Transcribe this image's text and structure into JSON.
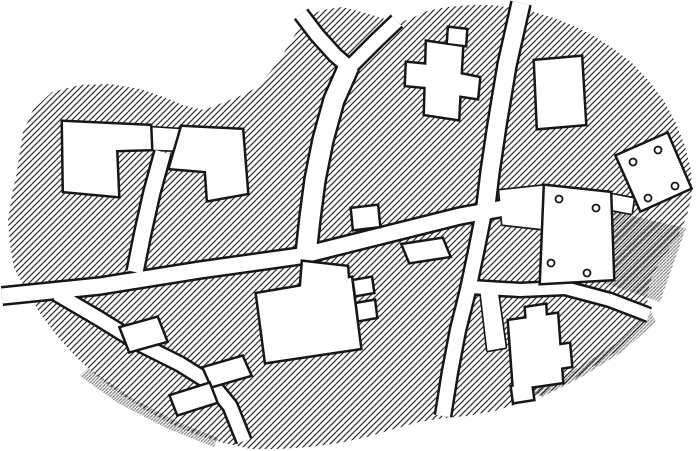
{
  "map": {
    "canvas": {
      "width": 700,
      "height": 451
    },
    "colors": {
      "paper": "#ffffff",
      "ink": "#161616",
      "hatch_line": "#2b2b2b",
      "hatch_dense": "#101010",
      "building_fill": "#ffffff",
      "road_fill": "#ffffff"
    },
    "hatch": {
      "spacing": 6,
      "line_width": 1.15,
      "dense_spacing": 3.4,
      "dense_line_width": 1.3,
      "shadow_opacity": 0.5
    },
    "boundary": [
      [
        14,
        268
      ],
      [
        10,
        245
      ],
      [
        8,
        220
      ],
      [
        12,
        195
      ],
      [
        17,
        172
      ],
      [
        20,
        150
      ],
      [
        23,
        132
      ],
      [
        33,
        110
      ],
      [
        52,
        92
      ],
      [
        80,
        85
      ],
      [
        110,
        84
      ],
      [
        140,
        89
      ],
      [
        164,
        97
      ],
      [
        185,
        106
      ],
      [
        204,
        110
      ],
      [
        222,
        103
      ],
      [
        240,
        96
      ],
      [
        256,
        88
      ],
      [
        271,
        71
      ],
      [
        285,
        51
      ],
      [
        296,
        33
      ],
      [
        304,
        18
      ],
      [
        322,
        10
      ],
      [
        342,
        7
      ],
      [
        362,
        12
      ],
      [
        382,
        18
      ],
      [
        396,
        23
      ],
      [
        410,
        19
      ],
      [
        427,
        11
      ],
      [
        447,
        7
      ],
      [
        470,
        5
      ],
      [
        492,
        5
      ],
      [
        514,
        8
      ],
      [
        534,
        12
      ],
      [
        554,
        18
      ],
      [
        574,
        26
      ],
      [
        594,
        36
      ],
      [
        614,
        49
      ],
      [
        632,
        63
      ],
      [
        649,
        81
      ],
      [
        664,
        101
      ],
      [
        676,
        123
      ],
      [
        685,
        146
      ],
      [
        691,
        170
      ],
      [
        692,
        194
      ],
      [
        687,
        216
      ],
      [
        679,
        234
      ],
      [
        669,
        249
      ],
      [
        659,
        263
      ],
      [
        651,
        279
      ],
      [
        647,
        296
      ],
      [
        649,
        313
      ],
      [
        644,
        326
      ],
      [
        631,
        339
      ],
      [
        614,
        353
      ],
      [
        594,
        366
      ],
      [
        571,
        381
      ],
      [
        547,
        393
      ],
      [
        521,
        403
      ],
      [
        494,
        411
      ],
      [
        467,
        416
      ],
      [
        444,
        418
      ],
      [
        419,
        422
      ],
      [
        394,
        429
      ],
      [
        367,
        437
      ],
      [
        339,
        443
      ],
      [
        309,
        447
      ],
      [
        279,
        449
      ],
      [
        251,
        449
      ],
      [
        224,
        443
      ],
      [
        197,
        435
      ],
      [
        171,
        424
      ],
      [
        147,
        411
      ],
      [
        123,
        396
      ],
      [
        99,
        378
      ],
      [
        77,
        358
      ],
      [
        57,
        336
      ],
      [
        39,
        312
      ],
      [
        25,
        288
      ]
    ],
    "shadows": [
      {
        "name": "shadow-east-slope",
        "points": [
          [
            615,
            212
          ],
          [
            686,
            228
          ],
          [
            660,
            302
          ],
          [
            601,
            282
          ]
        ]
      },
      {
        "name": "shadow-southeast-edge",
        "points": [
          [
            650,
            310
          ],
          [
            656,
            322
          ],
          [
            622,
            352
          ],
          [
            580,
            378
          ],
          [
            542,
            397
          ],
          [
            530,
            390
          ],
          [
            578,
            368
          ],
          [
            618,
            342
          ]
        ]
      },
      {
        "name": "shadow-southwest-edge",
        "points": [
          [
            88,
            368
          ],
          [
            132,
            398
          ],
          [
            178,
            422
          ],
          [
            218,
            438
          ],
          [
            214,
            447
          ],
          [
            166,
            428
          ],
          [
            118,
            403
          ],
          [
            80,
            376
          ]
        ]
      }
    ],
    "roads": [
      {
        "name": "road-high-street",
        "points": [
          [
            2,
            296
          ],
          [
            100,
            286
          ],
          [
            200,
            270
          ],
          [
            300,
            256
          ],
          [
            380,
            236
          ],
          [
            460,
            216
          ],
          [
            548,
            200
          ]
        ],
        "width": 15
      },
      {
        "name": "road-y-stem",
        "points": [
          [
            349,
            66
          ],
          [
            334,
            100
          ],
          [
            323,
            140
          ],
          [
            315,
            180
          ],
          [
            310,
            218
          ],
          [
            306,
            254
          ]
        ],
        "width": 19
      },
      {
        "name": "road-y-left-arm",
        "points": [
          [
            301,
            14
          ],
          [
            317,
            35
          ],
          [
            335,
            55
          ],
          [
            350,
            68
          ]
        ],
        "width": 13
      },
      {
        "name": "road-y-right-arm",
        "points": [
          [
            397,
            21
          ],
          [
            377,
            40
          ],
          [
            361,
            56
          ],
          [
            350,
            67
          ]
        ],
        "width": 13
      },
      {
        "name": "road-north",
        "points": [
          [
            521,
            3
          ],
          [
            507,
            65
          ],
          [
            497,
            125
          ],
          [
            490,
            172
          ],
          [
            485,
            214
          ]
        ],
        "width": 17
      },
      {
        "name": "road-south-cross",
        "points": [
          [
            484,
            212
          ],
          [
            476,
            252
          ],
          [
            468,
            290
          ],
          [
            458,
            330
          ],
          [
            450,
            372
          ],
          [
            443,
            416
          ]
        ],
        "width": 14
      },
      {
        "name": "road-east",
        "points": [
          [
            470,
            287
          ],
          [
            520,
            290
          ],
          [
            565,
            288
          ],
          [
            610,
            300
          ],
          [
            649,
            315
          ]
        ],
        "width": 12
      },
      {
        "name": "road-southwest",
        "points": [
          [
            57,
            294
          ],
          [
            98,
            318
          ],
          [
            140,
            344
          ],
          [
            180,
            364
          ],
          [
            212,
            384
          ],
          [
            230,
            406
          ],
          [
            244,
            441
          ]
        ],
        "width": 13
      },
      {
        "name": "road-west-lane",
        "points": [
          [
            163,
            152
          ],
          [
            152,
            192
          ],
          [
            143,
            232
          ],
          [
            135,
            272
          ]
        ],
        "width": 15
      }
    ],
    "plots": [
      {
        "name": "corridor-west-houses",
        "points": [
          [
            151,
            128
          ],
          [
            182,
            130
          ],
          [
            182,
            150
          ],
          [
            152,
            149
          ]
        ]
      },
      {
        "name": "corridor-east-courtyard",
        "points": [
          [
            607,
            194
          ],
          [
            633,
            199
          ],
          [
            631,
            213
          ],
          [
            605,
            208
          ]
        ]
      },
      {
        "name": "forecourt-courtyard",
        "points": [
          [
            500,
            191
          ],
          [
            546,
            186
          ],
          [
            548,
            229
          ],
          [
            503,
            224
          ]
        ]
      },
      {
        "name": "yard-lane-south",
        "points": [
          [
            481,
            290
          ],
          [
            497,
            291
          ],
          [
            505,
            347
          ],
          [
            488,
            350
          ]
        ]
      }
    ],
    "buildings": [
      {
        "name": "building-west-hall",
        "parts": [
          [
            [
              63,
              122
            ],
            [
              150,
              126
            ],
            [
              151,
              149
            ],
            [
              116,
              150
            ],
            [
              118,
              196
            ],
            [
              64,
              191
            ]
          ]
        ],
        "dots": []
      },
      {
        "name": "building-west-annex",
        "parts": [
          [
            [
              182,
              127
            ],
            [
              242,
              130
            ],
            [
              247,
              193
            ],
            [
              208,
              200
            ],
            [
              206,
              171
            ],
            [
              170,
              168
            ]
          ]
        ],
        "dots": []
      },
      {
        "name": "building-north-cross-house",
        "parts": [
          [
            [
              427,
              42
            ],
            [
              462,
              47
            ],
            [
              458,
              119
            ],
            [
              425,
              114
            ]
          ],
          [
            [
              449,
              28
            ],
            [
              466,
              30
            ],
            [
              465,
              45
            ],
            [
              448,
              43
            ]
          ],
          [
            [
              407,
              63
            ],
            [
              428,
              65
            ],
            [
              427,
              87
            ],
            [
              406,
              85
            ]
          ],
          [
            [
              459,
              74
            ],
            [
              479,
              78
            ],
            [
              477,
              98
            ],
            [
              457,
              95
            ]
          ]
        ],
        "dots": []
      },
      {
        "name": "building-north-east-house",
        "parts": [
          [
            [
              535,
              61
            ],
            [
              581,
              57
            ],
            [
              585,
              124
            ],
            [
              538,
              128
            ]
          ]
        ],
        "dots": []
      },
      {
        "name": "building-east-pillared-hall",
        "parts": [
          [
            [
              617,
              156
            ],
            [
              667,
              134
            ],
            [
              690,
              188
            ],
            [
              641,
              210
            ]
          ]
        ],
        "dots": [
          [
            633,
            162
          ],
          [
            658,
            150
          ],
          [
            675,
            186
          ],
          [
            648,
            198
          ]
        ]
      },
      {
        "name": "building-courtyard-pillared",
        "parts": [
          [
            [
              545,
              186
            ],
            [
              610,
              193
            ],
            [
              613,
              279
            ],
            [
              541,
              283
            ]
          ]
        ],
        "dots": [
          [
            559,
            199
          ],
          [
            596,
            208
          ],
          [
            551,
            263
          ],
          [
            587,
            273
          ]
        ]
      },
      {
        "name": "building-south-cross-house",
        "parts": [
          [
            [
              509,
              321
            ],
            [
              557,
              314
            ],
            [
              562,
              382
            ],
            [
              514,
              389
            ]
          ],
          [
            [
              526,
              308
            ],
            [
              545,
              305
            ],
            [
              546,
              320
            ],
            [
              527,
              323
            ]
          ],
          [
            [
              556,
              346
            ],
            [
              569,
              344
            ],
            [
              571,
              366
            ],
            [
              558,
              368
            ]
          ],
          [
            [
              512,
              387
            ],
            [
              531,
              384
            ],
            [
              533,
              399
            ],
            [
              514,
              402
            ]
          ]
        ],
        "dots": []
      },
      {
        "name": "building-roadside-cottage",
        "parts": [
          [
            [
              352,
              209
            ],
            [
              377,
              206
            ],
            [
              379,
              226
            ],
            [
              354,
              229
            ]
          ]
        ],
        "dots": []
      },
      {
        "name": "building-central-great-house",
        "parts": [
          [
            [
              257,
              294
            ],
            [
              351,
              278
            ],
            [
              360,
              348
            ],
            [
              266,
              362
            ]
          ],
          [
            [
              303,
              262
            ],
            [
              347,
              267
            ],
            [
              348,
              281
            ],
            [
              301,
              287
            ]
          ],
          [
            [
              354,
              281
            ],
            [
              371,
              278
            ],
            [
              373,
              292
            ],
            [
              356,
              295
            ]
          ],
          [
            [
              357,
              304
            ],
            [
              374,
              301
            ],
            [
              376,
              317
            ],
            [
              359,
              320
            ]
          ]
        ],
        "dots": []
      },
      {
        "name": "building-southwest-barn-1",
        "parts": [
          [
            [
              121,
              328
            ],
            [
              157,
              318
            ],
            [
              166,
              341
            ],
            [
              130,
              351
            ]
          ]
        ],
        "dots": []
      },
      {
        "name": "building-southwest-barn-2",
        "parts": [
          [
            [
              204,
              368
            ],
            [
              242,
              357
            ],
            [
              250,
              375
            ],
            [
              212,
              386
            ]
          ]
        ],
        "dots": []
      },
      {
        "name": "building-southwest-barn-3",
        "parts": [
          [
            [
              171,
              396
            ],
            [
              209,
              384
            ],
            [
              216,
              402
            ],
            [
              178,
              414
            ]
          ]
        ],
        "dots": []
      },
      {
        "name": "building-junction-barn",
        "parts": [
          [
            [
              403,
              245
            ],
            [
              442,
              239
            ],
            [
              449,
              256
            ],
            [
              410,
              262
            ]
          ]
        ],
        "dots": []
      }
    ]
  }
}
